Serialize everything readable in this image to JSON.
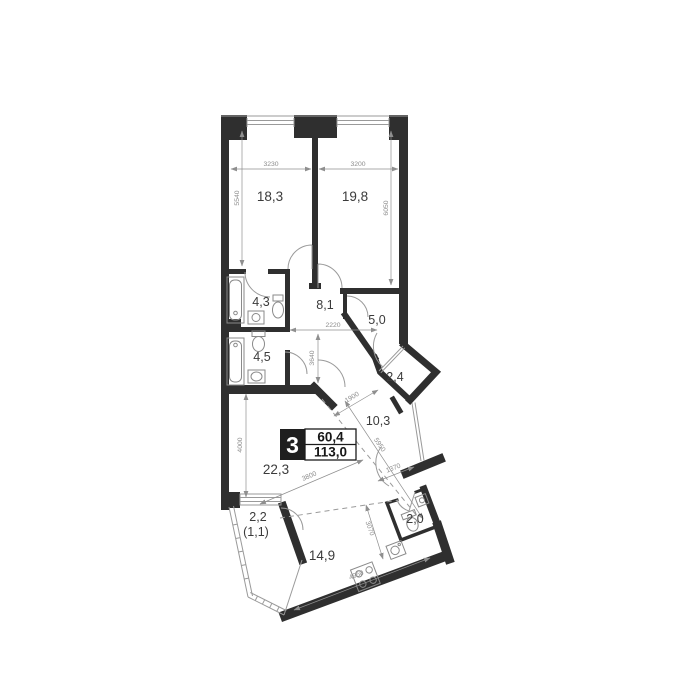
{
  "plan": {
    "title": "3-room apartment floor plan",
    "badge": {
      "room_count": "3",
      "living_area": "60,4",
      "total_area": "113,0"
    },
    "rooms": {
      "bedroom1": "18,3",
      "bedroom2": "19,8",
      "bathroom1": "4,3",
      "hallway": "8,1",
      "storage": "5,0",
      "bathroom2": "4,5",
      "loggia": "2,4",
      "corridor": "10,3",
      "living_room": "22,3",
      "balcony": "2,2",
      "balcony_reduced": "(1,1)",
      "wc": "2,0",
      "kitchen": "14,9"
    },
    "dimensions_mm": {
      "d3230": "3230",
      "d3200": "3200",
      "d5540": "5540",
      "d6050": "6050",
      "d2220": "2220",
      "d3640": "3640",
      "d1900": "1900",
      "d5950": "5950",
      "d1370": "1370",
      "d4000": "4000",
      "d3800": "3800",
      "d3070": "3070",
      "d4950": "4950"
    },
    "colors": {
      "wall": "#2f2f2f",
      "thin_line": "#9a9a9a",
      "dim_text": "#8c8c8c",
      "room_text": "#3b3b3b",
      "badge_bg": "#1f1f1f",
      "badge_text": "#ffffff"
    }
  }
}
